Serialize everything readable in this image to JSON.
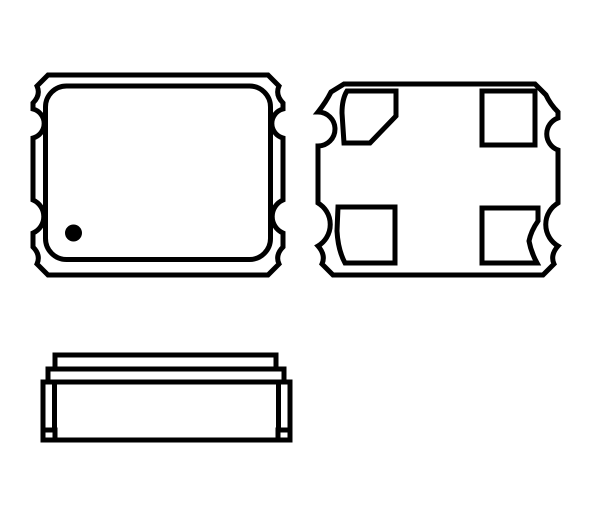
{
  "canvas": {
    "width": 600,
    "height": 514,
    "background_color": "#ffffff"
  },
  "drawing": {
    "stroke_color": "#000000",
    "fill_color": "#000000",
    "default_stroke_width": 5,
    "views": [
      {
        "name": "top-view",
        "shapes": [
          {
            "type": "path",
            "name": "top-view-outer-outline",
            "d": "M 48,75 L 268,75 L 279,86 Q 275,95 283,103 L 283,109 A 15,15 0 0 0 283,138 L 283,200 A 18,18 0 0 0 283,233 L 283,247 Q 275,255 279,264 L 268,275 L 48,275 L 37,264 Q 41,255 33,247 L 33,233 A 18,18 0 0 0 33,200 L 33,138 A 15,15 0 0 0 33,109 L 33,103 Q 41,95 37,86 Z"
          },
          {
            "type": "rect",
            "name": "top-view-lid-outline",
            "x": 45.5,
            "y": 86,
            "width": 225,
            "height": 173.5,
            "rx": 21
          },
          {
            "type": "circle",
            "name": "pin1-marker-dot",
            "cx": 73.5,
            "cy": 233,
            "r": 8.5,
            "fill": "#000000",
            "stroke_width": 0
          }
        ]
      },
      {
        "name": "bottom-view",
        "shapes": [
          {
            "type": "path",
            "name": "bottom-view-outer-outline",
            "d": "M 344,84 L 535,84 L 546,95 Q 550,104 558,112 L 558,118 A 17,17 0 0 0 558,150 L 558,203 A 25,25 0 0 0 558,246 Q 550,255 554,264 L 543,275 L 333,275 L 322,264 Q 326,255 318,246 A 25,25 0 0 0 318,203 L 318,146 A 17,17 0 0 0 318,112 Q 326,102 331,92 Z"
          },
          {
            "type": "path",
            "name": "pad-1-chamfered",
            "d": "M 347,91 L 396,91 L 396,116 L 370,143 L 344,143 L 342,113 Q 342,99 347,91 Z"
          },
          {
            "type": "rect",
            "name": "pad-2",
            "x": 482,
            "y": 91,
            "width": 53,
            "height": 54
          },
          {
            "type": "path",
            "name": "pad-3",
            "d": "M 482,208 L 538,208 L 538,221 Q 531,231 529,241 Q 531,252 537,263 L 482,263 Z"
          },
          {
            "type": "path",
            "name": "pad-4",
            "d": "M 338,207 L 395,207 L 395,263 L 345,263 Q 338,250 337,231 Z"
          }
        ]
      },
      {
        "name": "side-view",
        "shapes": [
          {
            "type": "rect",
            "name": "side-view-lid",
            "x": 55,
            "y": 355,
            "width": 221,
            "height": 14
          },
          {
            "type": "rect",
            "name": "side-view-seal-ring",
            "x": 48,
            "y": 369,
            "width": 236,
            "height": 13
          },
          {
            "type": "rect",
            "name": "side-view-base-body",
            "x": 43,
            "y": 382,
            "width": 247,
            "height": 58
          },
          {
            "type": "line",
            "name": "side-view-left-castellation-line",
            "x1": 54.5,
            "y1": 384,
            "x2": 54.5,
            "y2": 430
          },
          {
            "type": "line",
            "name": "side-view-right-castellation-line",
            "x1": 278.5,
            "y1": 384,
            "x2": 278.5,
            "y2": 430
          },
          {
            "type": "rect",
            "name": "side-view-left-foot-pad",
            "x": 43,
            "y": 430,
            "width": 12,
            "height": 10
          },
          {
            "type": "rect",
            "name": "side-view-right-foot-pad",
            "x": 278,
            "y": 430,
            "width": 12,
            "height": 10
          }
        ]
      }
    ]
  }
}
